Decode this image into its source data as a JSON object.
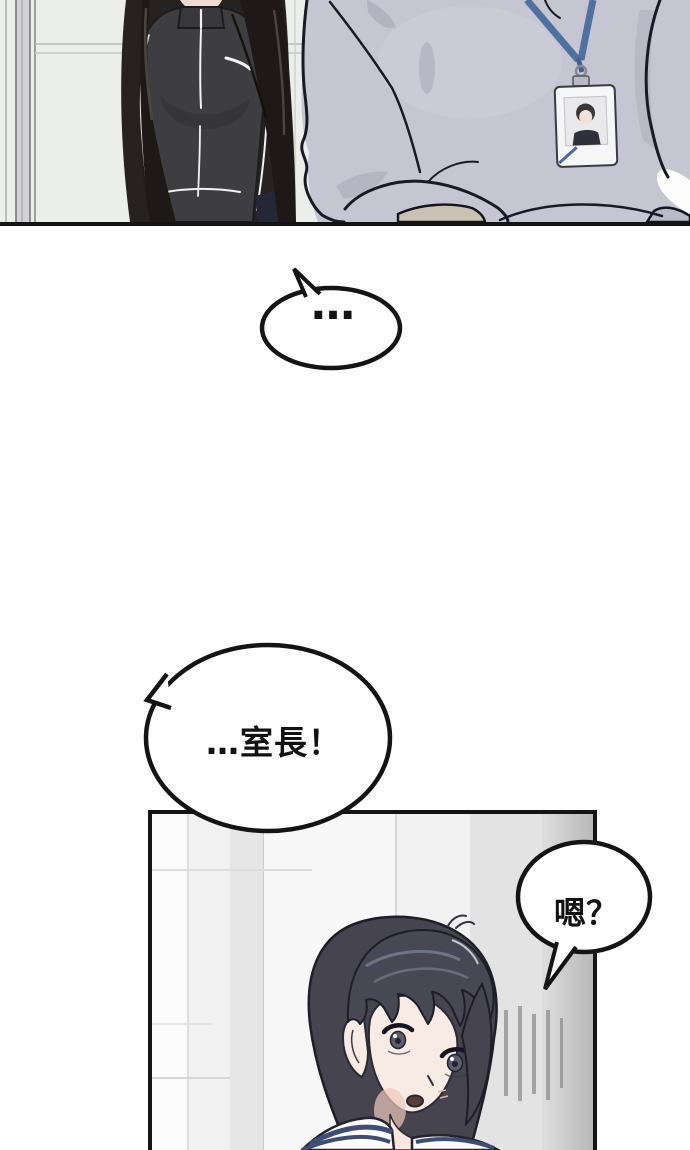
{
  "bubbles": {
    "ellipsis": {
      "text": "…"
    },
    "call": {
      "text": "…室長！"
    },
    "reply": {
      "text": "嗯？"
    }
  },
  "colors": {
    "panel_border": "#141414",
    "wall_top": "#eceeec",
    "jacket_dark": "#3e3e42",
    "hair_left_character": "#27221f",
    "hoodie_gray": "#c6c6d2",
    "lanyard_blue": "#50719f",
    "badge_white": "#f6f6f6",
    "wall_bottom": "#f2f2f2",
    "girl_hair": "#45444f",
    "skin": "#f8ebe4",
    "sailor_collar_navy": "#3d4d74",
    "bubble_fill": "#ffffff"
  }
}
